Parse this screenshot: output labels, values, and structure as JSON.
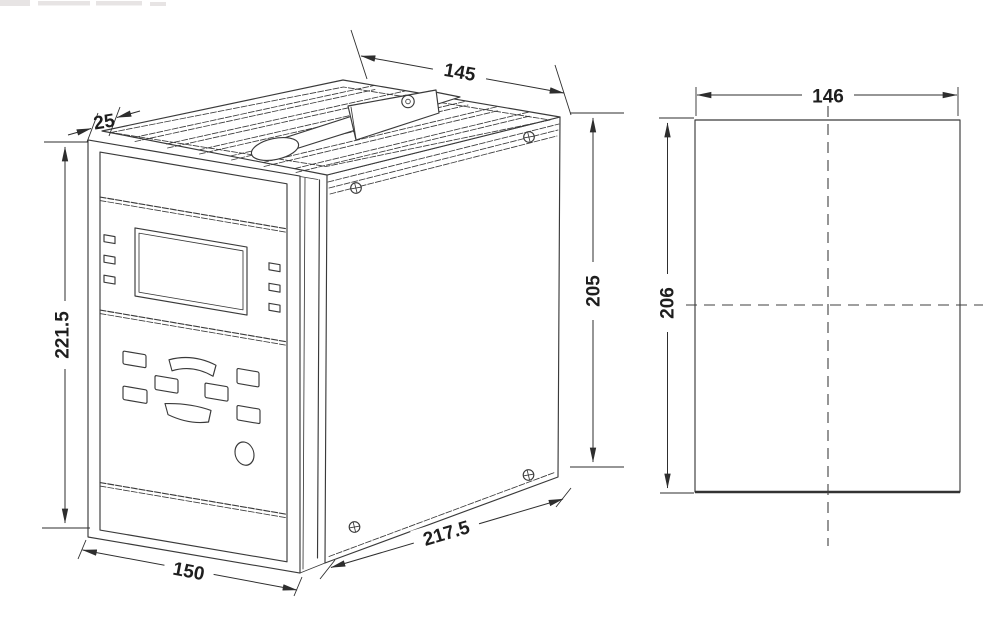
{
  "page": {
    "background": "#ffffff"
  },
  "drawing": {
    "stroke_color": "#3a3a3a",
    "text_color": "#1e1e1e",
    "views": {
      "isometric": {
        "label": "device-isometric-view",
        "dimensions": {
          "bezel_depth": "25",
          "top_width": "145",
          "panel_height": "221.5",
          "case_height": "205",
          "case_depth": "217.5",
          "panel_width": "150"
        }
      },
      "cutout": {
        "label": "panel-cutout-view",
        "dimensions": {
          "width": "146",
          "height": "206"
        }
      }
    }
  }
}
